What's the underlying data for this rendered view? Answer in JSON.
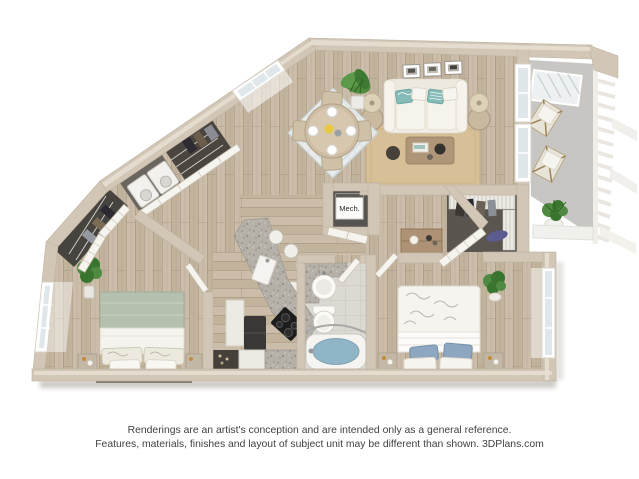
{
  "floorplan": {
    "mech_label": "Mech."
  },
  "disclaimer": {
    "line1": "Renderings are an artist's conception and are intended only as a general reference.",
    "line2": "Features, materials, finishes and layout of subject unit may be different than shown.",
    "brand": "3DPlans.com"
  },
  "colors": {
    "wall": "#d2c7b6",
    "wall_edge": "#bfb3a0",
    "wall_light": "#e8e1d4",
    "floor_light": "#cbbda9",
    "floor_dark": "#b9aa94",
    "plank_line": "#9b8b76",
    "tile": "#dcd9d3",
    "grout": "#c8c5be",
    "concrete": "#c7c6c2",
    "rug_jute": "#d7bf97",
    "rug_dining": "#e9eceb",
    "rug_dining_accent": "#b9c9d3",
    "sofa": "#f3f0e8",
    "teal": "#85bcb7",
    "water": "#8fb5c6",
    "sage": "#b6c0ae",
    "blue_pillow": "#8ca7bf",
    "granite_base": "#b5b1a8",
    "granite_dot": "#8f8b82",
    "dark_appliance": "#3a3836",
    "plant": "#4e8a42",
    "plant_dark": "#39752f",
    "wood_furniture": "#b09678",
    "white_furniture": "#f2f0ea",
    "text": "#414141"
  }
}
